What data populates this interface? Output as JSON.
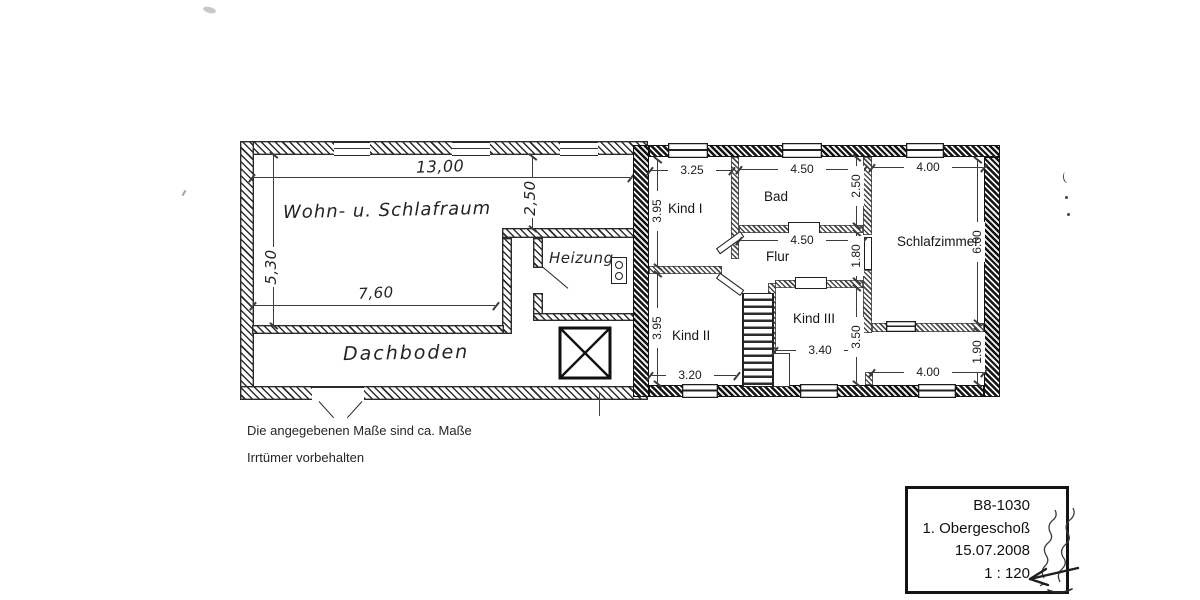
{
  "colors": {
    "ink": "#1e1e1e",
    "paper": "#ffffff"
  },
  "plan": {
    "left_wing": {
      "room_wohn": "Wohn- u. Schlafraum",
      "room_heizung": "Heizung",
      "room_dachboden": "Dachboden",
      "dim_width_total": "13,00",
      "dim_height_left": "5,30",
      "dim_width_inner": "7,60",
      "dim_height_mid": "2,50"
    },
    "right_wing": {
      "room_kind1": "Kind I",
      "room_bad": "Bad",
      "room_flur": "Flur",
      "room_kind2": "Kind II",
      "room_kind3": "Kind III",
      "room_schlafzimmer": "Schlafzimmer",
      "dim_kind1_top": "3.25",
      "dim_bad_top": "4.50",
      "dim_schlaf_top": "4.00",
      "dim_kind1_left": "3.95",
      "dim_bad_right": "2.50",
      "dim_schlaf_right": "6.00",
      "dim_flur_width": "4.50",
      "dim_flur_right": "1.80",
      "dim_kind2_left": "3.95",
      "dim_kind3_width": "3.40",
      "dim_kind3_right": "3.50",
      "dim_kind2_bottom": "3.20",
      "dim_schlaf_bottom": "4.00",
      "dim_below_schlaf_right": "1.90"
    }
  },
  "notes": {
    "line1": "Die angegebenen Maße sind ca. Maße",
    "line2": "Irrtümer vorbehalten"
  },
  "title_block": {
    "drawing_no": "B8-1030",
    "floor": "1. Obergeschoß",
    "date": "15.07.2008",
    "scale": "1 : 120"
  }
}
